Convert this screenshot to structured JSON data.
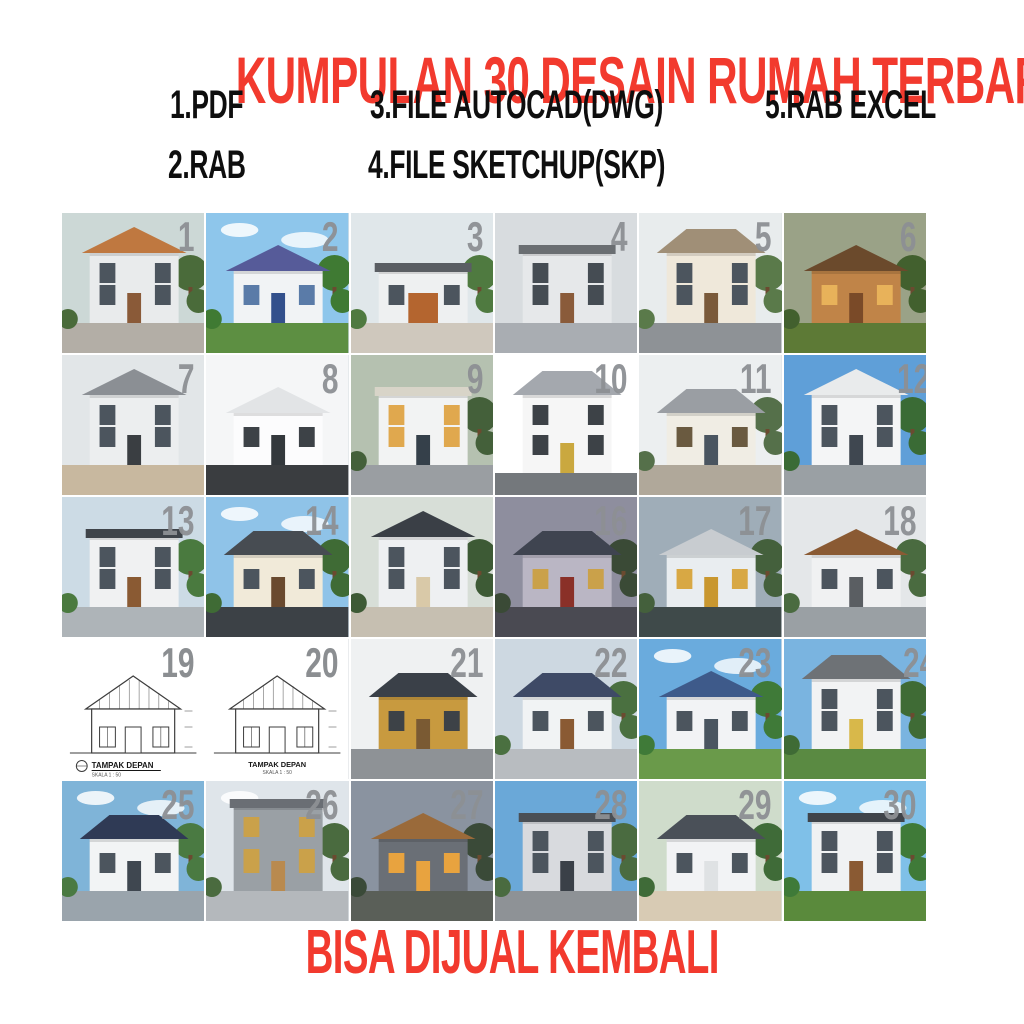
{
  "header": {
    "title": "KUMPULAN 30 DESAIN RUMAH TERBARU",
    "title_color": "#f23a2e",
    "features": [
      {
        "label": "1.PDF"
      },
      {
        "label": "2.RAB"
      },
      {
        "label": "3.FILE AUTOCAD(DWG)"
      },
      {
        "label": "4.FILE SKETCHUP(SKP)"
      },
      {
        "label": "5.RAB EXCEL"
      }
    ]
  },
  "footer": {
    "text": "BISA DIJUAL KEMBALI",
    "color": "#f23a2e"
  },
  "grid": {
    "columns": 6,
    "rows": 5,
    "number_color": "#8d9094",
    "tiles": [
      {
        "number": "1",
        "floors": 2,
        "roof": "gable",
        "sky": "#ccd8d6",
        "wall": "#e9ebec",
        "roof_color": "#bf7840",
        "ground": "#b3aea6",
        "accent": "#8a5a38",
        "window": "#4c555e",
        "tree": "#4a6b3a"
      },
      {
        "number": "2",
        "floors": 1,
        "roof": "gable",
        "sky": "#8ec6eb",
        "clouds": true,
        "wall": "#f1f3f5",
        "roof_color": "#565b99",
        "ground": "#5d8f42",
        "accent": "#33508c",
        "window": "#5a7ba8",
        "tree": "#3f7a33"
      },
      {
        "number": "3",
        "floors": 1,
        "roof": "flat",
        "sky": "#e0e7ea",
        "wall": "#eef0f1",
        "roof_color": "#5a5e63",
        "ground": "#cfc8bd",
        "accent": "#b4652f",
        "door_w": 30,
        "window": "#4c555e",
        "tree": "#4f7a40"
      },
      {
        "number": "4",
        "floors": 2,
        "roof": "flat",
        "sky": "#d8dcdf",
        "wall": "#e6e8ea",
        "roof_color": "#6a6e72",
        "ground": "#a9adb2",
        "accent": "#8a5b3a",
        "window": "#454c53"
      },
      {
        "number": "5",
        "floors": 2,
        "roof": "hip",
        "sky": "#e8eced",
        "wall": "#efe8da",
        "roof_color": "#a08f77",
        "ground": "#8e9296",
        "accent": "#7a5a3a",
        "window": "#4c555e",
        "tree": "#5a7a4a"
      },
      {
        "number": "6",
        "floors": 1,
        "roof": "gable",
        "sky": "#9aa287",
        "wall": "#c08448",
        "roof_color": "#6b4a2c",
        "ground": "#5d7a36",
        "accent": "#7a4a28",
        "window": "#e8b25a",
        "tree": "#42602e"
      },
      {
        "number": "7",
        "floors": 2,
        "roof": "gable",
        "sky": "#e2e6e8",
        "wall": "#eceeef",
        "roof_color": "#8b8f94",
        "ground": "#c8b89f",
        "accent": "#3a3e42",
        "window": "#4c555e"
      },
      {
        "number": "8",
        "floors": 1,
        "roof": "gable",
        "sky": "#f5f6f7",
        "wall": "#fcfcfd",
        "roof_color": "#e2e4e6",
        "ground": "#3a3d40",
        "accent": "#33383c",
        "window": "#3d4247"
      },
      {
        "number": "9",
        "floors": 2,
        "roof": "flat",
        "sky": "#b5c1b0",
        "wall": "#f2f3f3",
        "roof_color": "#d8d4c8",
        "ground": "#9a9ea2",
        "accent": "#35404a",
        "window": "#e0a84e",
        "tree": "#44603a"
      },
      {
        "number": "10",
        "floors": 2,
        "roof": "hip",
        "sky": "#ffffff",
        "wall": "#f6f6f6",
        "roof_color": "#a4a8ae",
        "ground": "#74787c",
        "accent": "#caa83f",
        "window": "#3d4247",
        "ground_h": 22
      },
      {
        "number": "11",
        "floors": 1,
        "roof": "hip",
        "sky": "#eceff0",
        "wall": "#f0ede4",
        "roof_color": "#9a9ea3",
        "ground": "#b0a89a",
        "accent": "#4a5560",
        "window": "#6a5a40",
        "tree": "#55704a"
      },
      {
        "number": "12",
        "floors": 2,
        "roof": "gable",
        "sky": "#5f9fd8",
        "wall": "#f4f5f6",
        "roof_color": "#e9ebec",
        "ground": "#9aa0a4",
        "accent": "#3f4750",
        "window": "#4c555e",
        "tree": "#3a6b35",
        "num_x": 148
      },
      {
        "number": "13",
        "floors": 2,
        "roof": "flat",
        "sky": "#ccdbe5",
        "wall": "#f0f1f2",
        "roof_color": "#3f444a",
        "ground": "#aeb4b8",
        "accent": "#8a5a33",
        "window": "#4c555e",
        "tree": "#4a7a3f"
      },
      {
        "number": "14",
        "floors": 1,
        "roof": "hip",
        "sky": "#8fc3e8",
        "clouds": true,
        "wall": "#f1ead9",
        "roof_color": "#474c52",
        "ground": "#3c4146",
        "accent": "#6a4a2f",
        "window": "#4c555e",
        "tree": "#3f6b35"
      },
      {
        "number": "15",
        "number_visible": false,
        "floors": 2,
        "roof": "gable",
        "sky": "#d7ded7",
        "wall": "#eef0f2",
        "roof_color": "#3a3f46",
        "ground": "#c6bfb1",
        "accent": "#d9c9a8",
        "window": "#4c555e",
        "tree": "#3d5a35"
      },
      {
        "number": "16",
        "floors": 1,
        "roof": "hip",
        "sky": "#8e8e9e",
        "wall": "#bab6c4",
        "roof_color": "#3f4450",
        "ground": "#4a4a52",
        "accent": "#8a3028",
        "window": "#caa14a",
        "tree": "#3a4a36"
      },
      {
        "number": "17",
        "floors": 1,
        "roof": "gable",
        "sky": "#9fadb8",
        "wall": "#e9edf0",
        "roof_color": "#c8ccd0",
        "ground": "#3f4a4a",
        "accent": "#c9972f",
        "window": "#d8a844",
        "tree": "#44603c"
      },
      {
        "number": "18",
        "floors": 1,
        "roof": "gable",
        "sky": "#e4e7e9",
        "wall": "#f0f1f2",
        "roof_color": "#8a5a33",
        "ground": "#9aa0a4",
        "accent": "#5a5e62",
        "window": "#4c555e",
        "tree": "#4a6b40"
      },
      {
        "number": "19",
        "style": "cad",
        "label": "TAMPAK DEPAN",
        "sublabel": "SKALA 1 : 50",
        "label_align": "left"
      },
      {
        "number": "20",
        "style": "cad",
        "label": "TAMPAK DEPAN",
        "sublabel": "SKALA 1 : 50",
        "label_align": "center"
      },
      {
        "number": "21",
        "floors": 1,
        "roof": "hip",
        "sky": "#eff1f2",
        "wall": "#c89a3f",
        "roof_color": "#3a4048",
        "ground": "#8e9296",
        "accent": "#7a5a33",
        "window": "#3d4247"
      },
      {
        "number": "22",
        "floors": 1,
        "roof": "hip",
        "sky": "#cdd8e1",
        "wall": "#f1f3f4",
        "roof_color": "#3e4a66",
        "ground": "#b8bcc0",
        "accent": "#8a5a33",
        "window": "#4c555e",
        "tree": "#4a7040"
      },
      {
        "number": "23",
        "floors": 1,
        "roof": "gable",
        "sky": "#6aabdd",
        "clouds": true,
        "wall": "#f2f3f5",
        "roof_color": "#3e5a8a",
        "ground": "#6a9a4a",
        "accent": "#4a5560",
        "window": "#4c555e",
        "tree": "#3f7a38"
      },
      {
        "number": "24",
        "floors": 2,
        "roof": "hip",
        "sky": "#7ab4e0",
        "wall": "#f2f3f4",
        "roof_color": "#6e7276",
        "ground": "#5a8a42",
        "accent": "#d8b84a",
        "window": "#4c555e",
        "tree": "#3f6b35",
        "num_x": 154
      },
      {
        "number": "25",
        "floors": 1,
        "roof": "hip",
        "sky": "#7fb4d8",
        "clouds": true,
        "wall": "#f2f4f5",
        "roof_color": "#2f3a55",
        "ground": "#9aa4ac",
        "accent": "#3f4750",
        "window": "#4c555e",
        "tree": "#4a7a42"
      },
      {
        "number": "26",
        "floors": 3,
        "roof": "flat",
        "sky": "#dfe5ea",
        "clouds": true,
        "wall": "#9aa0a5",
        "roof_color": "#6a6e74",
        "ground": "#b4b8bc",
        "accent": "#b98a4f",
        "window": "#caa14a",
        "tree": "#4a6b3f"
      },
      {
        "number": "27",
        "floors": 1,
        "roof": "gable",
        "sky": "#8a93a0",
        "wall": "#6a6f76",
        "roof_color": "#9a6a3a",
        "ground": "#5a5f58",
        "accent": "#e8a33f",
        "window": "#e8a33f",
        "tree": "#3a4a38"
      },
      {
        "number": "28",
        "floors": 2,
        "roof": "flat",
        "sky": "#6aa8d8",
        "wall": "#d8dade",
        "roof_color": "#4a4f55",
        "ground": "#8e9296",
        "accent": "#3a4048",
        "window": "#4c555e",
        "tree": "#4a6b40"
      },
      {
        "number": "29",
        "floors": 1,
        "roof": "hip",
        "sky": "#cfdccb",
        "wall": "#f2f3f5",
        "roof_color": "#4a5058",
        "ground": "#d8cbb4",
        "accent": "#dfe2e4",
        "window": "#4c555e",
        "tree": "#3f6b38"
      },
      {
        "number": "30",
        "floors": 2,
        "roof": "flat",
        "sky": "#7fc0e8",
        "clouds": true,
        "wall": "#f0f2f3",
        "roof_color": "#3f444a",
        "ground": "#5a8a3c",
        "accent": "#8a5a33",
        "window": "#4c555e",
        "tree": "#3f7a38"
      }
    ]
  }
}
